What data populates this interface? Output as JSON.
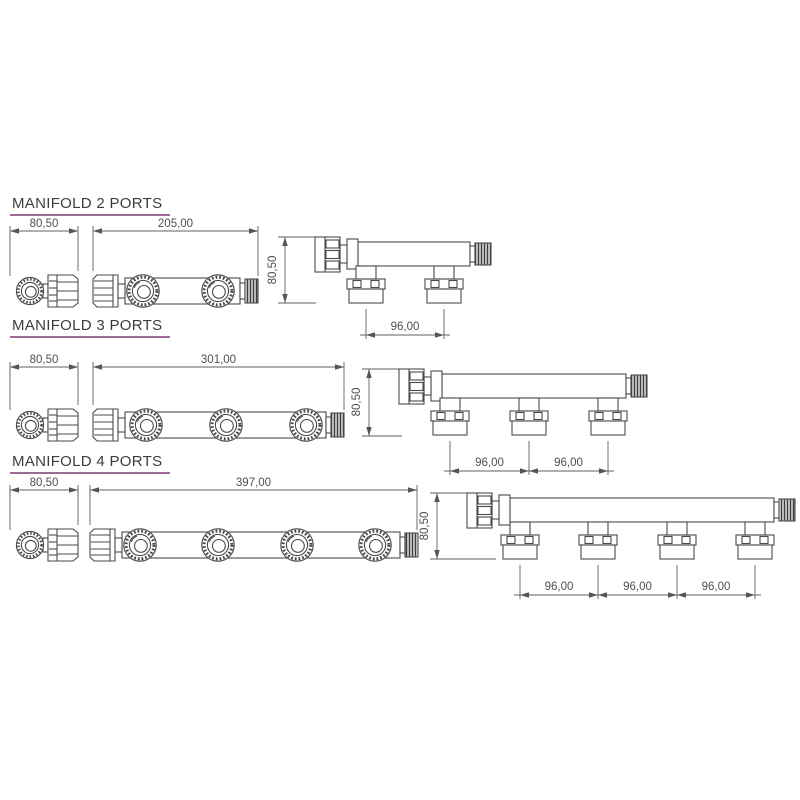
{
  "page": {
    "background": "#ffffff"
  },
  "colors": {
    "underline": "#9d6b96",
    "line": "#4a4a4a",
    "dim_text": "#4f4f4f",
    "title_text": "#3d3d3d"
  },
  "sections": [
    {
      "id": "manifold-2-ports",
      "title": "MANIFOLD 2 PORTS",
      "ports": 2,
      "dims": {
        "end_width": "80,50",
        "overall_length": "205,00",
        "height": "80,50",
        "port_spacing": [
          "96,00"
        ]
      }
    },
    {
      "id": "manifold-3-ports",
      "title": "MANIFOLD 3 PORTS",
      "ports": 3,
      "dims": {
        "end_width": "80,50",
        "overall_length": "301,00",
        "height": "80,50",
        "port_spacing": [
          "96,00",
          "96,00"
        ]
      }
    },
    {
      "id": "manifold-4-ports",
      "title": "MANIFOLD 4 PORTS",
      "ports": 4,
      "dims": {
        "end_width": "80,50",
        "overall_length": "397,00",
        "height": "80,50",
        "port_spacing": [
          "96,00",
          "96,00",
          "96,00"
        ]
      }
    }
  ]
}
